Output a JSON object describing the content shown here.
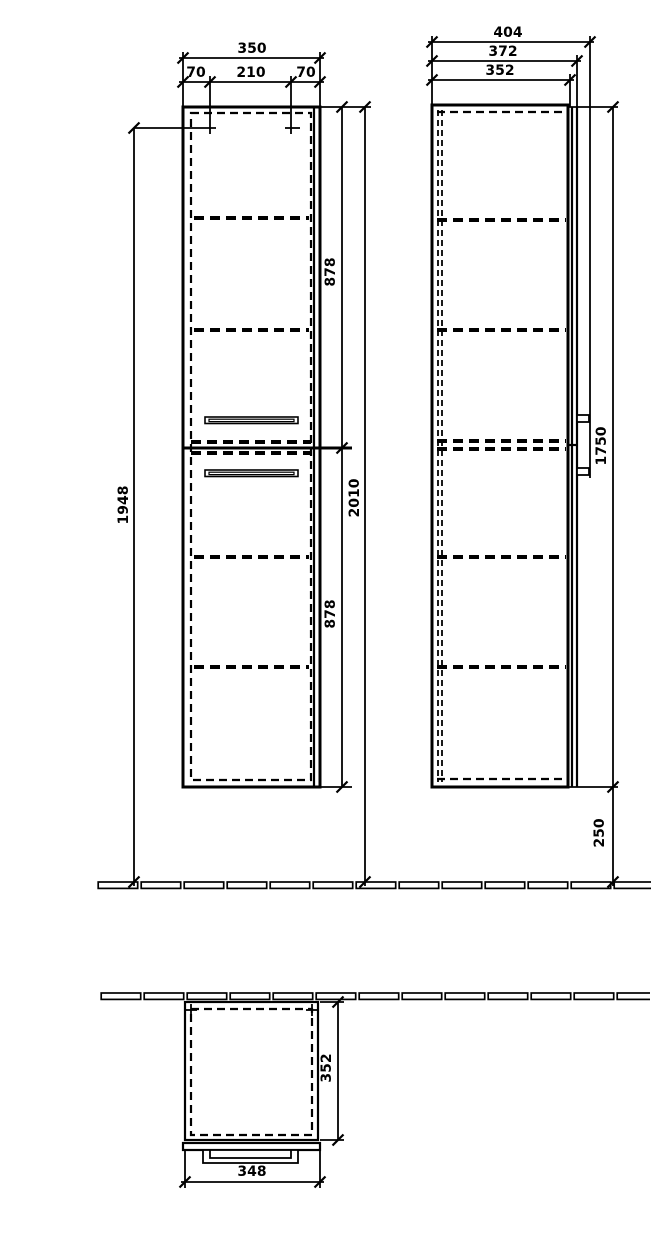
{
  "drawing": {
    "front_view": {
      "dim_width_total": "350",
      "dim_offset_left": "70",
      "dim_width_center": "210",
      "dim_offset_right": "70",
      "dim_height_to_rail": "1948",
      "dim_upper_section": "878",
      "dim_height_total": "2010",
      "dim_lower_section": "878"
    },
    "side_view": {
      "dim_depth_total": "404",
      "dim_depth_with_door": "372",
      "dim_depth_carcass": "352",
      "dim_height_carcass": "1750",
      "dim_floor_clearance": "250"
    },
    "plan_view": {
      "dim_depth": "352",
      "dim_width": "348"
    },
    "colors": {
      "line": "#000000",
      "background": "#ffffff"
    }
  }
}
